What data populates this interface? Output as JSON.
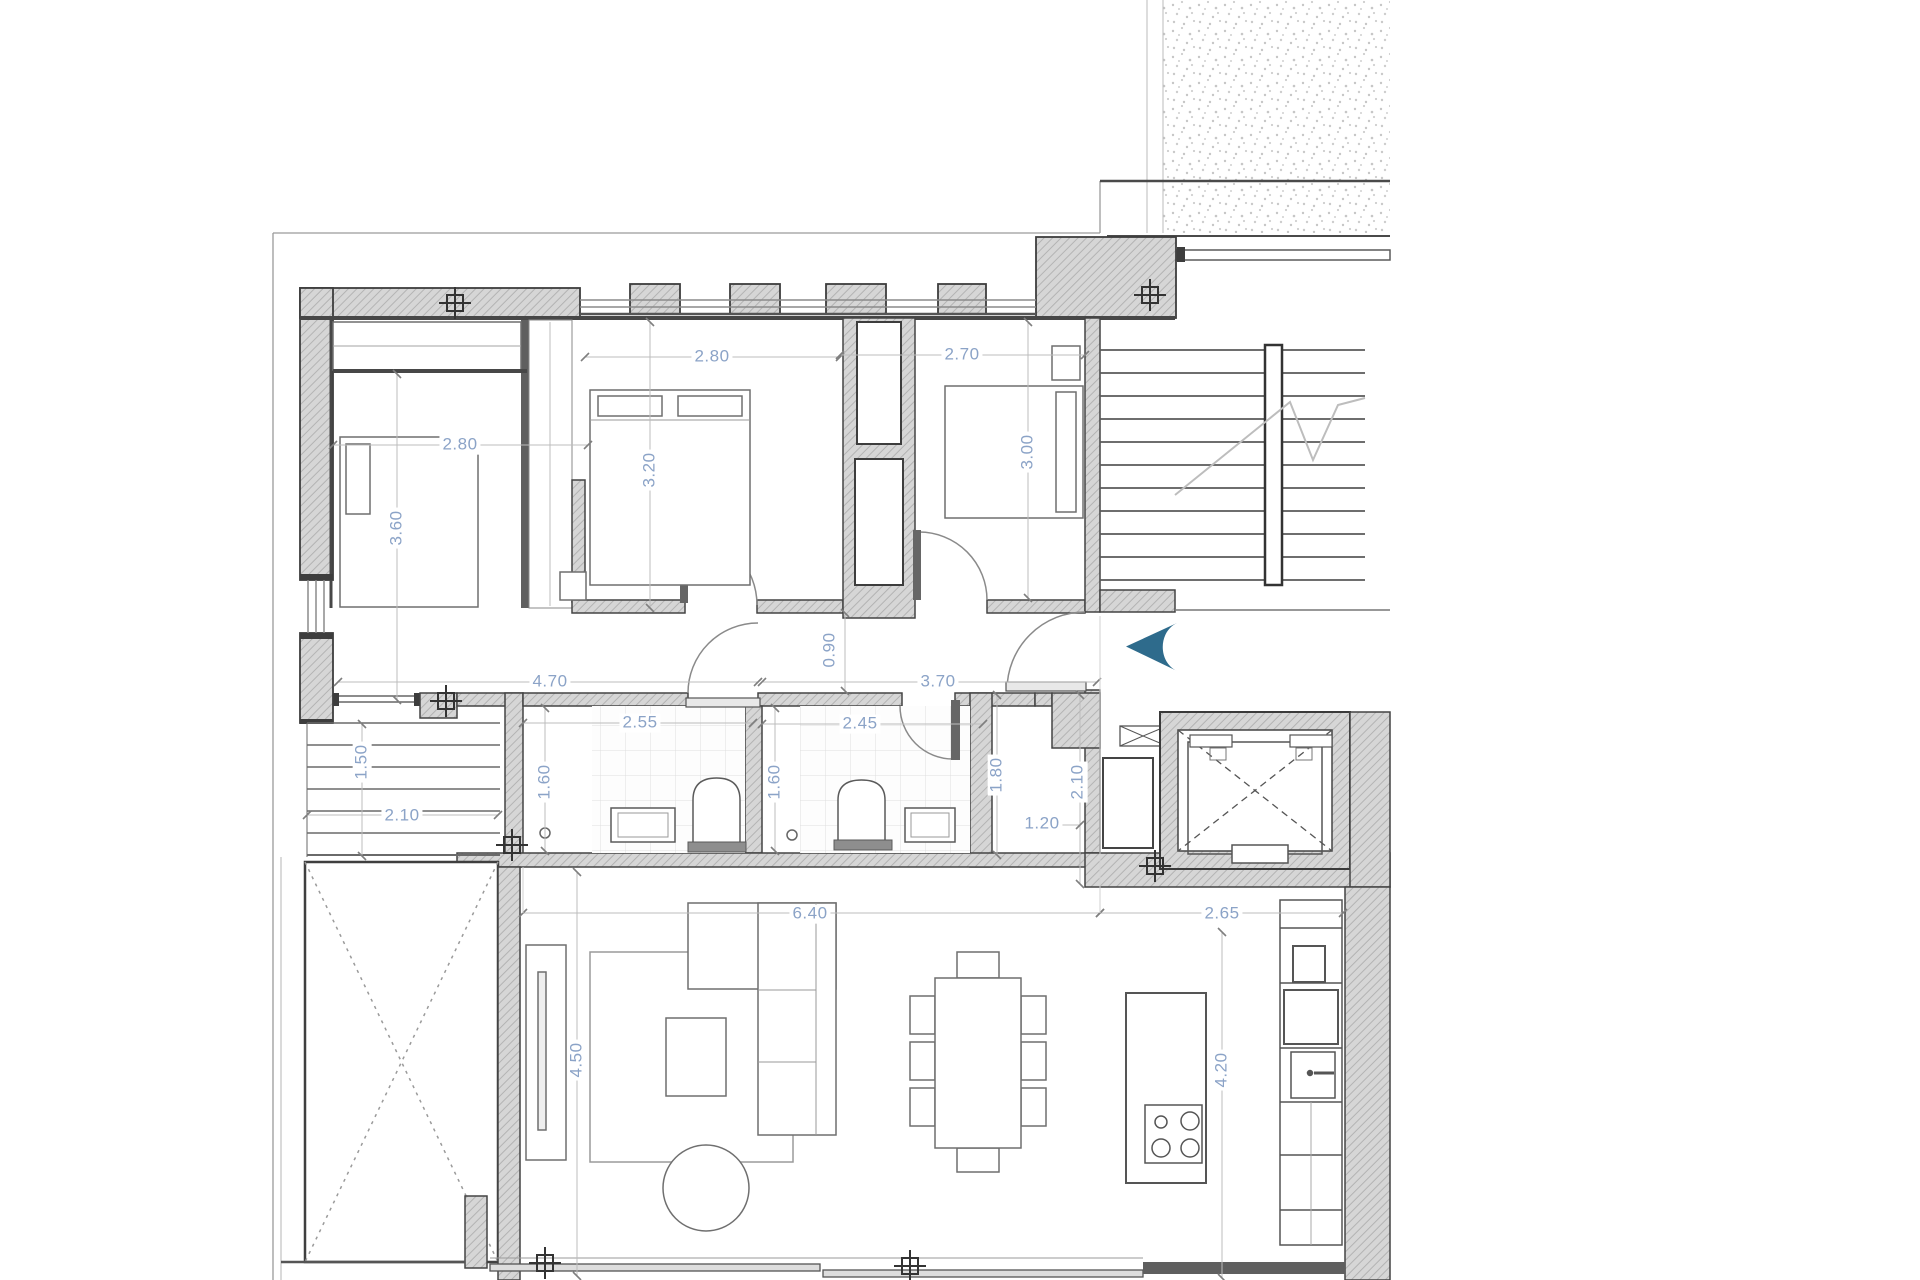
{
  "plan": {
    "type": "apartment-floor-plan",
    "colors": {
      "dimension_text": "#8ba3c7",
      "entry_arrow": "#2e6b8c",
      "wall_fill": "#d6d6d6",
      "outline": "#3d3d3d"
    },
    "dimensions": {
      "bedroom1_width": "2.80",
      "bedroom1_depth": "3.60",
      "bedroom2_width": "2.80",
      "bedroom2_depth": "3.20",
      "bedroom3_width": "2.70",
      "bedroom3_depth": "3.00",
      "hallway_left": "4.70",
      "hallway_right": "3.70",
      "hallway_width": "0.90",
      "bathroom1_width": "2.55",
      "bathroom1_depth": "1.60",
      "bathroom2_width": "2.45",
      "bathroom2_depth": "1.60",
      "bathroom2_side": "1.80",
      "entry_depth": "2.10",
      "entry_width": "1.20",
      "side_stair_depth": "1.50",
      "side_stair_width": "2.10",
      "living_width": "6.40",
      "kitchen_width": "2.65",
      "living_depth": "4.50",
      "kitchen_depth": "4.20"
    }
  }
}
